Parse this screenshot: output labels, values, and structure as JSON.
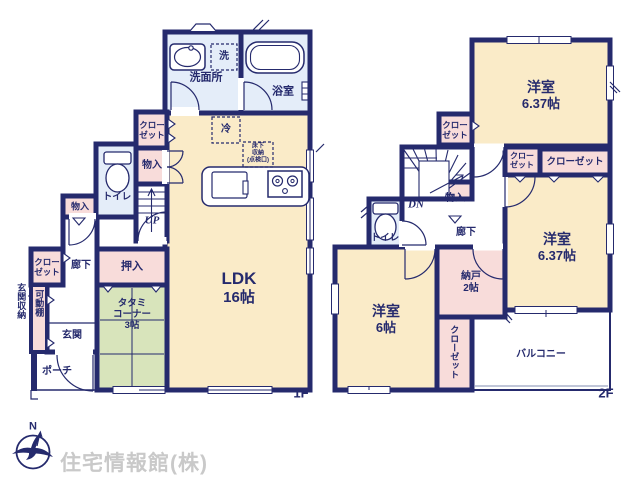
{
  "colors": {
    "wall_navy": "#252a6d",
    "room_cream": "#faebc8",
    "room_pink": "#f8dcda",
    "room_blue": "#e4edf9",
    "tatami_green": "#d8e4bb",
    "logo_gray": "#c9c9c9",
    "background": "#ffffff"
  },
  "shared": {
    "closet_line1": "クロー",
    "closet_line2": "ゼット",
    "closet_full": "クローゼット",
    "storage": "物入",
    "toilet": "トイレ",
    "hallway": "廊下",
    "western_room": "洋室"
  },
  "floor1": {
    "label": "1F",
    "washroom": "洗面所",
    "washer": "洗",
    "bath": "浴室",
    "fridge": "冷",
    "underfloor_line1": "床下",
    "underfloor_line2": "収納",
    "underfloor_line3": "(点検口)",
    "stairs": "UP",
    "oshiire": "押入",
    "ldk_name": "LDK",
    "ldk_size": "16帖",
    "tatami_line1": "タタミ",
    "tatami_line2": "コーナー",
    "tatami_line3": "3帖",
    "entrance_storage": "玄関収納",
    "movable_shelf": "可動棚",
    "entrance": "玄関",
    "porch": "ポーチ"
  },
  "floor2": {
    "label": "2F",
    "room_a_size": "6.37帖",
    "room_b_size": "6.37帖",
    "room_c_size": "6帖",
    "stairs": "DN",
    "storage_room": "納戸",
    "storage_room_size": "2帖",
    "balcony": "バルコニー"
  },
  "compass": {
    "north": "N"
  },
  "logo": {
    "company": "住宅情報館(株)"
  }
}
